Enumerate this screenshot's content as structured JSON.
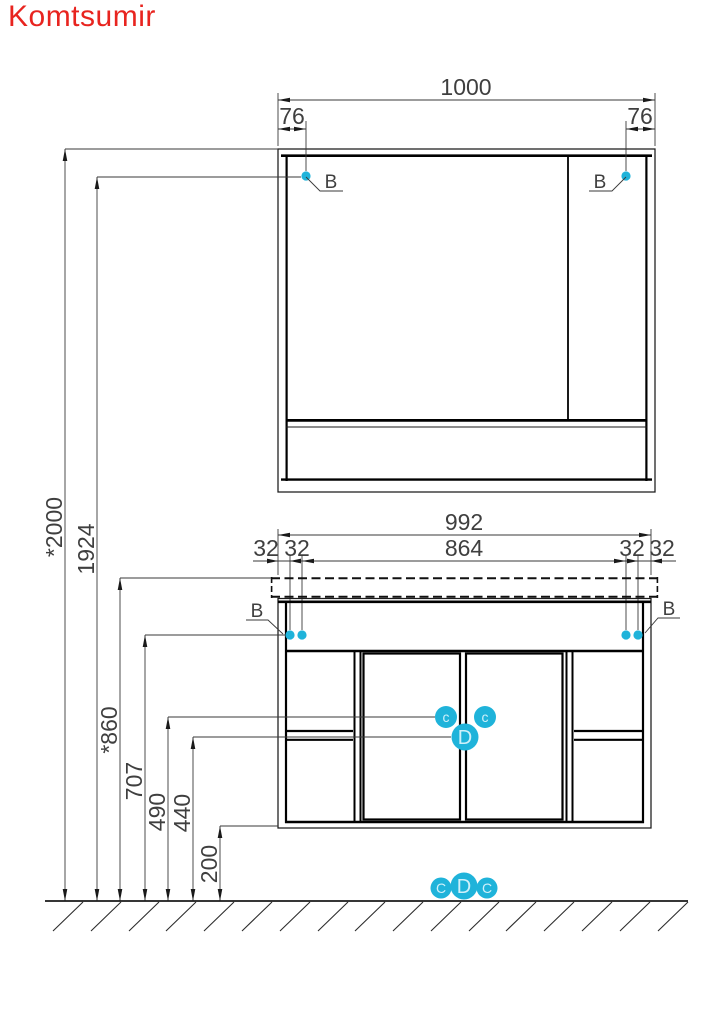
{
  "title": "Komtsumir",
  "colors": {
    "accent": "#1fb3da",
    "circle_letter": "#cff0fa",
    "title": "#e8241f"
  },
  "mirror_cabinet": {
    "width_label": "1000",
    "left_offset_label": "76",
    "right_offset_label": "76",
    "left_mount_label": "B",
    "right_mount_label": "B"
  },
  "vanity": {
    "width_label": "992",
    "inner_width_label": "864",
    "offset_labels": [
      "32",
      "32",
      "32",
      "32"
    ],
    "left_mount_label": "B",
    "right_mount_label": "B",
    "callout_left": "c",
    "callout_right": "c",
    "callout_center": "D"
  },
  "floor_callouts": [
    "C",
    "D",
    "C"
  ],
  "height_labels": {
    "overall": "*2000",
    "mirror_mounts": "1924",
    "worktop": "*860",
    "vanity_mounts": "707",
    "hinge_line": "490",
    "center_line": "440",
    "bottom_clearance": "200"
  }
}
